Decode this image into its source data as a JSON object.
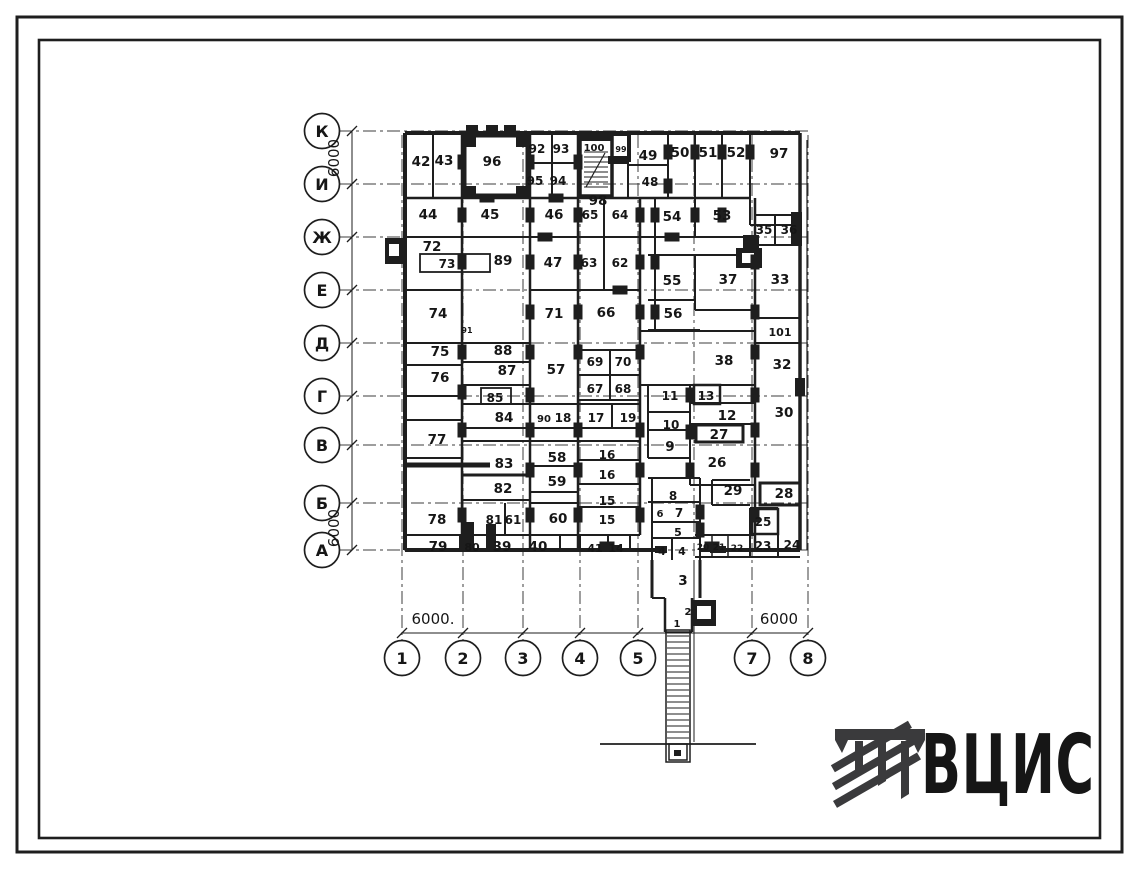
{
  "drawing": {
    "type": "floor-plan",
    "ink_color": "#1e1e1e",
    "background": "#ffffff"
  },
  "logo": {
    "text": "ВЦИС",
    "color": "#3a3a3c"
  },
  "axes": {
    "rows": [
      {
        "label": "К",
        "y": 131
      },
      {
        "label": "И",
        "y": 184
      },
      {
        "label": "Ж",
        "y": 237
      },
      {
        "label": "Е",
        "y": 290
      },
      {
        "label": "Д",
        "y": 343
      },
      {
        "label": "Г",
        "y": 396
      },
      {
        "label": "В",
        "y": 445
      },
      {
        "label": "Б",
        "y": 503
      },
      {
        "label": "А",
        "y": 550
      }
    ],
    "cols": [
      {
        "label": "1",
        "x": 402
      },
      {
        "label": "2",
        "x": 463
      },
      {
        "label": "3",
        "x": 523
      },
      {
        "label": "4",
        "x": 580
      },
      {
        "label": "5",
        "x": 638
      },
      {
        "label": "7",
        "x": 752
      },
      {
        "label": "8",
        "x": 808
      }
    ],
    "hidden_col_line_x": 694
  },
  "dimensions": [
    {
      "text": "6000",
      "x": 339,
      "y": 158,
      "rotated": true
    },
    {
      "text": "6000",
      "x": 339,
      "y": 528,
      "rotated": true
    },
    {
      "text": "6000.",
      "x": 433,
      "y": 624,
      "rotated": false
    },
    {
      "text": "6000",
      "x": 779,
      "y": 624,
      "rotated": false
    }
  ],
  "rooms": [
    {
      "n": "42",
      "x": 421,
      "y": 161
    },
    {
      "n": "43",
      "x": 444,
      "y": 160
    },
    {
      "n": "96",
      "x": 492,
      "y": 161
    },
    {
      "n": "92",
      "x": 537,
      "y": 148,
      "fs": 12
    },
    {
      "n": "93",
      "x": 561,
      "y": 148,
      "fs": 12
    },
    {
      "n": "100",
      "x": 594,
      "y": 146,
      "fs": 10
    },
    {
      "n": "99",
      "x": 621,
      "y": 147,
      "fs": 8
    },
    {
      "n": "95",
      "x": 535,
      "y": 180,
      "fs": 12
    },
    {
      "n": "94",
      "x": 558,
      "y": 180,
      "fs": 12
    },
    {
      "n": "49",
      "x": 648,
      "y": 155
    },
    {
      "n": "48",
      "x": 650,
      "y": 181,
      "fs": 12
    },
    {
      "n": "50",
      "x": 680,
      "y": 152
    },
    {
      "n": "51",
      "x": 708,
      "y": 152
    },
    {
      "n": "52",
      "x": 736,
      "y": 152
    },
    {
      "n": "97",
      "x": 779,
      "y": 153
    },
    {
      "n": "98",
      "x": 598,
      "y": 200
    },
    {
      "n": "44",
      "x": 428,
      "y": 214
    },
    {
      "n": "45",
      "x": 490,
      "y": 214
    },
    {
      "n": "46",
      "x": 554,
      "y": 214
    },
    {
      "n": "65",
      "x": 590,
      "y": 214,
      "fs": 12
    },
    {
      "n": "64",
      "x": 620,
      "y": 214,
      "fs": 12
    },
    {
      "n": "54",
      "x": 672,
      "y": 216
    },
    {
      "n": "53",
      "x": 722,
      "y": 215
    },
    {
      "n": "35",
      "x": 764,
      "y": 229,
      "fs": 12
    },
    {
      "n": "36",
      "x": 789,
      "y": 229,
      "fs": 12
    },
    {
      "n": "72",
      "x": 432,
      "y": 246
    },
    {
      "n": "73",
      "x": 447,
      "y": 263,
      "fs": 12
    },
    {
      "n": "89",
      "x": 503,
      "y": 260
    },
    {
      "n": "47",
      "x": 553,
      "y": 262
    },
    {
      "n": "63",
      "x": 589,
      "y": 262,
      "fs": 12
    },
    {
      "n": "62",
      "x": 620,
      "y": 262,
      "fs": 12
    },
    {
      "n": "55",
      "x": 672,
      "y": 280
    },
    {
      "n": "37",
      "x": 728,
      "y": 279
    },
    {
      "n": "33",
      "x": 780,
      "y": 279
    },
    {
      "n": "74",
      "x": 438,
      "y": 313
    },
    {
      "n": "71",
      "x": 554,
      "y": 313
    },
    {
      "n": "66",
      "x": 606,
      "y": 312
    },
    {
      "n": "56",
      "x": 673,
      "y": 313
    },
    {
      "n": "91",
      "x": 467,
      "y": 328,
      "fs": 8
    },
    {
      "n": "101",
      "x": 780,
      "y": 331,
      "fs": 11
    },
    {
      "n": "38",
      "x": 724,
      "y": 360
    },
    {
      "n": "32",
      "x": 782,
      "y": 364
    },
    {
      "n": "75",
      "x": 440,
      "y": 351
    },
    {
      "n": "88",
      "x": 503,
      "y": 350
    },
    {
      "n": "76",
      "x": 440,
      "y": 377
    },
    {
      "n": "87",
      "x": 507,
      "y": 370
    },
    {
      "n": "57",
      "x": 556,
      "y": 369
    },
    {
      "n": "69",
      "x": 595,
      "y": 361,
      "fs": 12
    },
    {
      "n": "70",
      "x": 623,
      "y": 361,
      "fs": 12
    },
    {
      "n": "67",
      "x": 595,
      "y": 388,
      "fs": 12
    },
    {
      "n": "68",
      "x": 623,
      "y": 388,
      "fs": 12
    },
    {
      "n": "85",
      "x": 495,
      "y": 397,
      "fs": 12
    },
    {
      "n": "84",
      "x": 504,
      "y": 417
    },
    {
      "n": "90",
      "x": 544,
      "y": 417,
      "fs": 10
    },
    {
      "n": "18",
      "x": 563,
      "y": 417,
      "fs": 12
    },
    {
      "n": "17",
      "x": 596,
      "y": 417,
      "fs": 12
    },
    {
      "n": "19",
      "x": 628,
      "y": 417,
      "fs": 12
    },
    {
      "n": "11",
      "x": 670,
      "y": 395,
      "fs": 12
    },
    {
      "n": "13",
      "x": 706,
      "y": 395,
      "fs": 12
    },
    {
      "n": "12",
      "x": 727,
      "y": 415
    },
    {
      "n": "10",
      "x": 671,
      "y": 424,
      "fs": 12
    },
    {
      "n": "27",
      "x": 719,
      "y": 434
    },
    {
      "n": "9",
      "x": 670,
      "y": 446
    },
    {
      "n": "26",
      "x": 717,
      "y": 462
    },
    {
      "n": "30",
      "x": 784,
      "y": 412
    },
    {
      "n": "77",
      "x": 437,
      "y": 439
    },
    {
      "n": "83",
      "x": 504,
      "y": 463
    },
    {
      "n": "58",
      "x": 557,
      "y": 457
    },
    {
      "n": "16",
      "x": 607,
      "y": 454,
      "fs": 12
    },
    {
      "n": "16",
      "x": 607,
      "y": 474,
      "fs": 12
    },
    {
      "n": "82",
      "x": 503,
      "y": 488
    },
    {
      "n": "59",
      "x": 557,
      "y": 481
    },
    {
      "n": "15",
      "x": 607,
      "y": 500,
      "fs": 12
    },
    {
      "n": "78",
      "x": 437,
      "y": 519
    },
    {
      "n": "29",
      "x": 733,
      "y": 490
    },
    {
      "n": "28",
      "x": 784,
      "y": 493
    },
    {
      "n": "8",
      "x": 673,
      "y": 495,
      "fs": 12
    },
    {
      "n": "25",
      "x": 763,
      "y": 521,
      "fs": 12
    },
    {
      "n": "6",
      "x": 660,
      "y": 512,
      "fs": 10
    },
    {
      "n": "7",
      "x": 679,
      "y": 512,
      "fs": 12
    },
    {
      "n": "5",
      "x": 678,
      "y": 531,
      "fs": 11
    },
    {
      "n": "81",
      "x": 494,
      "y": 519,
      "fs": 12
    },
    {
      "n": "61",
      "x": 513,
      "y": 519,
      "fs": 12
    },
    {
      "n": "60",
      "x": 558,
      "y": 518
    },
    {
      "n": "15",
      "x": 607,
      "y": 519,
      "fs": 12
    },
    {
      "n": "79",
      "x": 438,
      "y": 546
    },
    {
      "n": "80",
      "x": 472,
      "y": 546,
      "fs": 11
    },
    {
      "n": "39",
      "x": 502,
      "y": 546
    },
    {
      "n": "40",
      "x": 538,
      "y": 546
    },
    {
      "n": "41",
      "x": 595,
      "y": 547,
      "fs": 11
    },
    {
      "n": "14",
      "x": 616,
      "y": 547,
      "fs": 11
    },
    {
      "n": "4",
      "x": 662,
      "y": 550,
      "fs": 11
    },
    {
      "n": "4",
      "x": 682,
      "y": 550,
      "fs": 11
    },
    {
      "n": "20",
      "x": 703,
      "y": 545,
      "fs": 9
    },
    {
      "n": "21",
      "x": 719,
      "y": 545,
      "fs": 9
    },
    {
      "n": "22",
      "x": 737,
      "y": 546,
      "fs": 9
    },
    {
      "n": "23",
      "x": 763,
      "y": 545,
      "fs": 12
    },
    {
      "n": "24",
      "x": 792,
      "y": 544,
      "fs": 12
    },
    {
      "n": "3",
      "x": 683,
      "y": 580
    },
    {
      "n": "2",
      "x": 688,
      "y": 610,
      "fs": 10
    },
    {
      "n": "1",
      "x": 677,
      "y": 622,
      "fs": 10
    }
  ]
}
